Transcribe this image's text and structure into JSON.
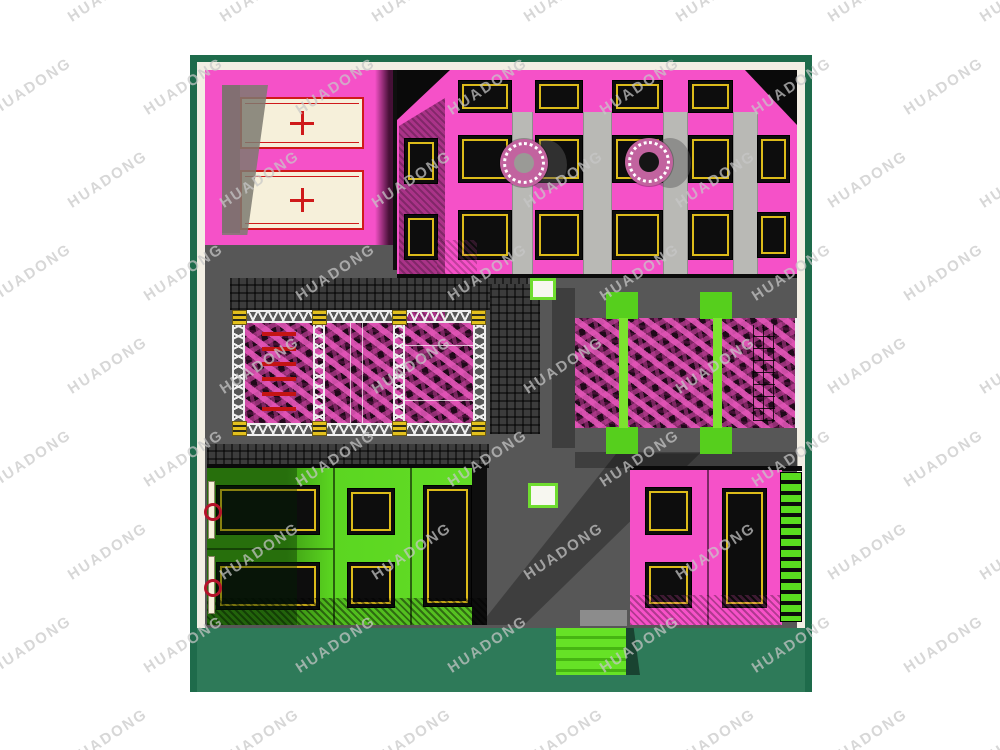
{
  "watermark": {
    "text": "HUADONG"
  },
  "colors": {
    "frame_green": "#1e6b4b",
    "floor_teal": "#2e7a59",
    "floor_gray": "#575757",
    "wall_cream": "#f3efe4",
    "zone_pink": "#f551c8",
    "wall_magenta": "#9e2f7f",
    "zone_green": "#56cf1d",
    "bed_black": "#0d0d0d",
    "bed_trim_yellow": "#dcbb1a",
    "mat_cream": "#f6f0da",
    "mat_red": "#cf1a1a",
    "foam_pink": "#d94fb4",
    "truss_white": "#efefef",
    "watermark_gray": "#c8c8c8"
  }
}
